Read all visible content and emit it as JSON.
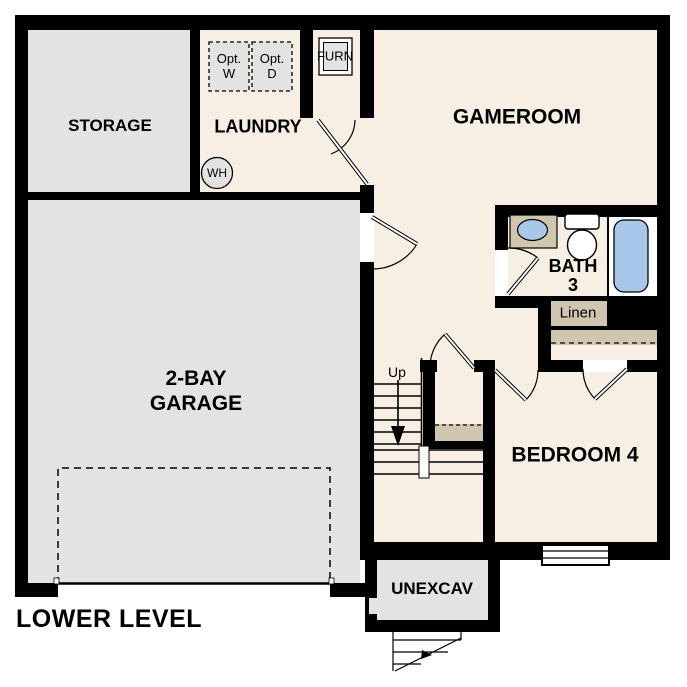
{
  "plan": {
    "title": "LOWER LEVEL"
  },
  "rooms": {
    "storage": {
      "label": "STORAGE"
    },
    "laundry": {
      "label": "LAUNDRY"
    },
    "gameroom": {
      "label": "GAMEROOM"
    },
    "garage": {
      "label_line1": "2-BAY",
      "label_line2": "GARAGE"
    },
    "bath3": {
      "label_line1": "BATH",
      "label_line2": "3"
    },
    "bedroom4": {
      "label": "BEDROOM 4"
    },
    "unexcav": {
      "label": "UNEXCAV"
    },
    "linen": {
      "label": "Linen"
    }
  },
  "fixtures": {
    "furnace": {
      "label": "FURN"
    },
    "water_heater": {
      "label": "WH"
    },
    "opt_washer": {
      "label_line1": "Opt.",
      "label_line2": "W"
    },
    "opt_dryer": {
      "label_line1": "Opt.",
      "label_line2": "D"
    },
    "stairs": {
      "up_label": "Up"
    }
  },
  "colors": {
    "wall": "#000000",
    "beige": "#f7efe4",
    "gray": "#e3e3e1",
    "tan": "#d0c5ae",
    "blue": "#a7c8e8",
    "bg": "#ffffff",
    "ink": "#000000"
  }
}
